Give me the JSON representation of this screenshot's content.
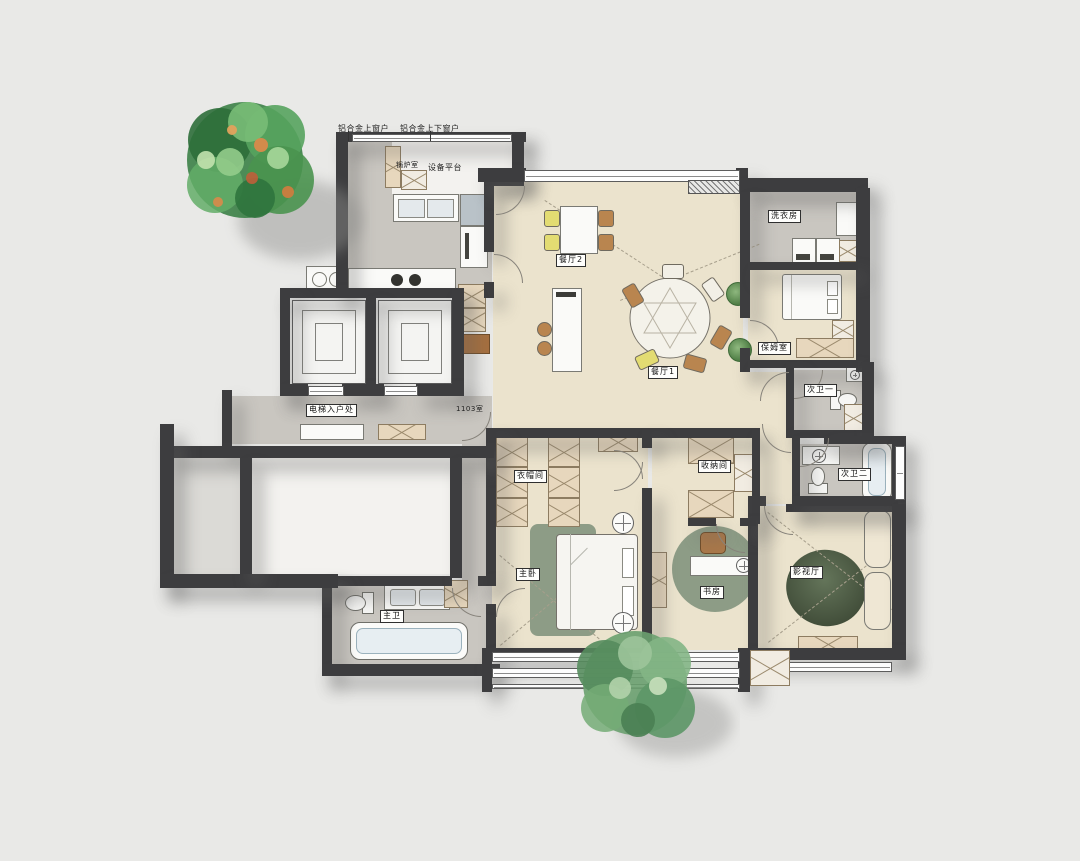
{
  "labels": {
    "window_top": "铝合金上窗户",
    "window_top_bottom": "铝合金上下窗户",
    "boiler_room": "锅炉室",
    "equipment_platform": "设备平台",
    "dining_2": "餐厅2",
    "dining_1": "餐厅1",
    "laundry": "洗衣房",
    "nanny_room": "保姆室",
    "bath_1": "次卫一",
    "bath_2": "次卫二",
    "elevator_entry": "电梯入户处",
    "unit_number": "1103室",
    "closet": "衣帽间",
    "storage": "收纳间",
    "master_bedroom": "主卧",
    "study": "书房",
    "media_room": "影视厅",
    "master_bath": "主卫"
  },
  "palette": {
    "background": "#e9e9e7",
    "wall": "#3d3d3f",
    "floor_main": "#ebe3cd",
    "floor_service": "#c9c6c0",
    "cabinet_wood": "#e7d7bd",
    "rug_sage": "#8d9c86",
    "rug_dark_green": "#4f6049",
    "chair_yellow": "#e3dc72",
    "wood_brown": "#b9854f",
    "tree_green": "#4d9b55"
  }
}
